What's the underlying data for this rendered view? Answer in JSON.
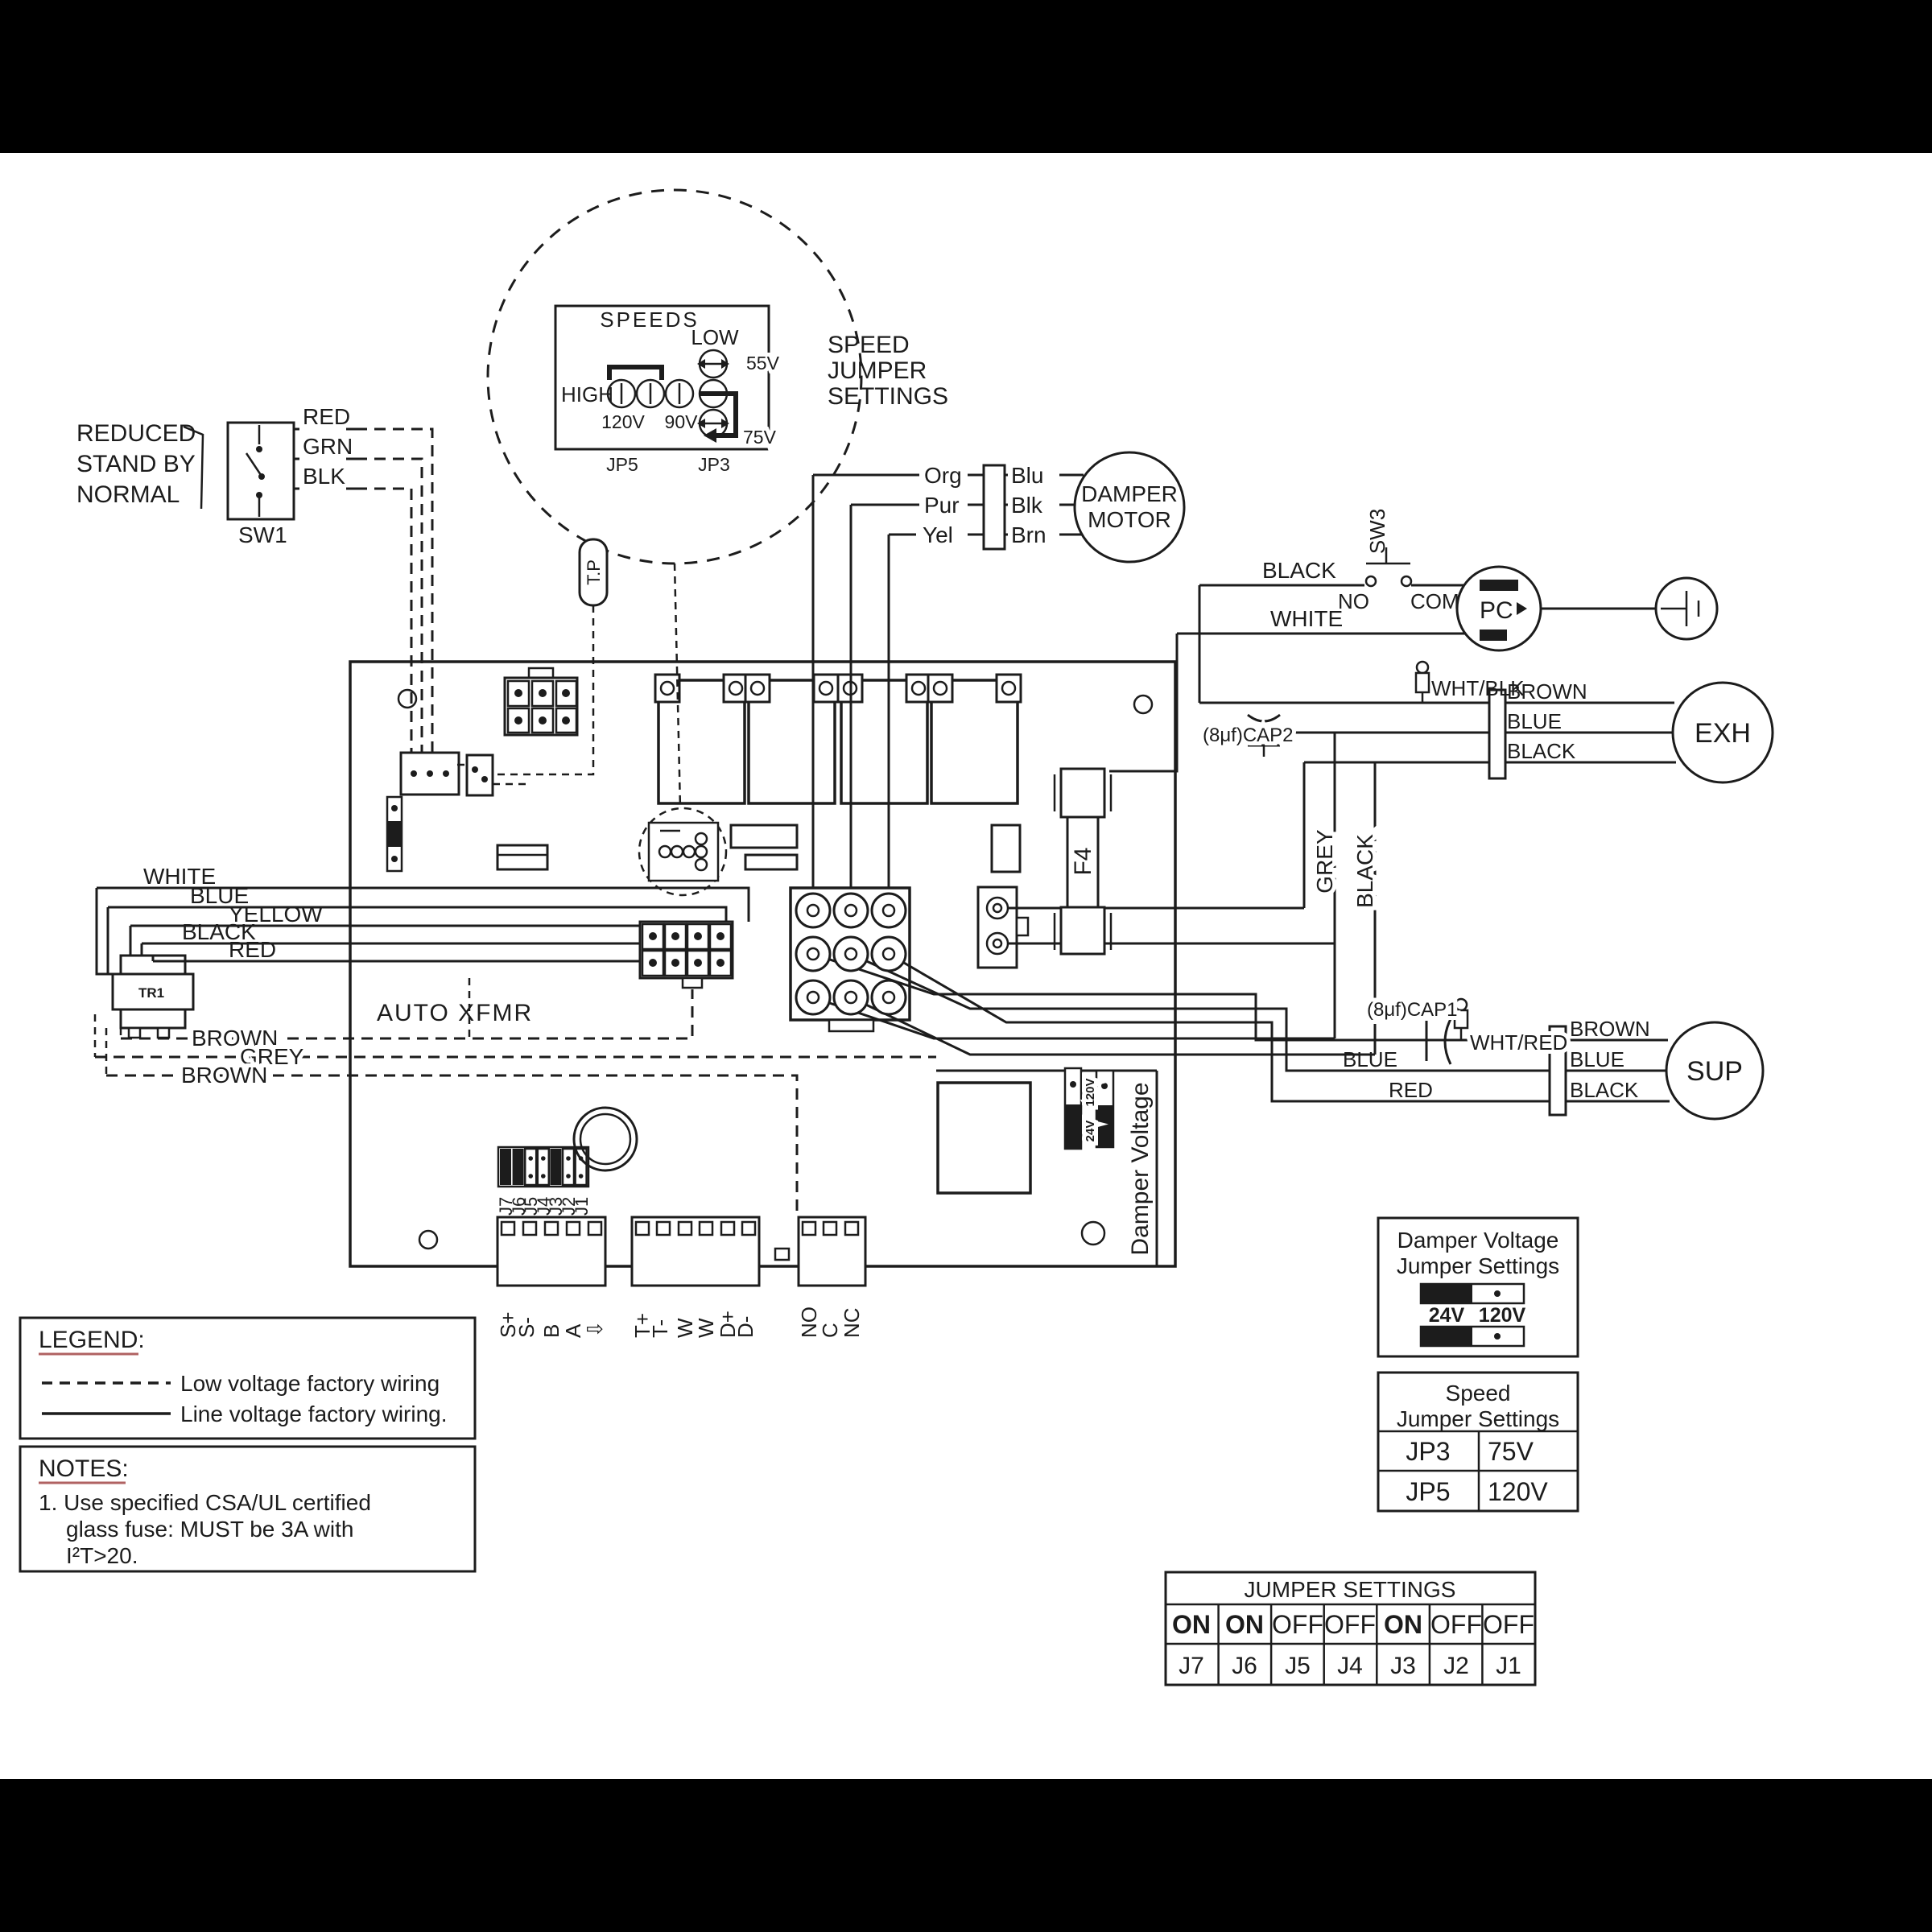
{
  "sw1": {
    "line1": "REDUCED",
    "line2": "STAND BY",
    "line3": "NORMAL",
    "name": "SW1",
    "wires": [
      "RED",
      "GRN",
      "BLK"
    ]
  },
  "speed_detail": {
    "title": "SPEEDS",
    "low": "LOW",
    "high": "HIGH",
    "v120": "120V",
    "v90": "90V",
    "v55": "55V",
    "v75": "75V",
    "jp5": "JP5",
    "jp3": "JP3",
    "callout": [
      "SPEED",
      "JUMPER",
      "SETTINGS"
    ]
  },
  "damper_motor": {
    "left": [
      "Org",
      "Pur",
      "Yel"
    ],
    "right": [
      "Blu",
      "Blk",
      "Brn"
    ],
    "name1": "DAMPER",
    "name2": "MOTOR"
  },
  "tp": {
    "label": "T.P"
  },
  "sw3": {
    "name": "SW3",
    "black": "BLACK",
    "white": "WHITE",
    "no": "NO",
    "com": "COM"
  },
  "pc": {
    "label": "PC"
  },
  "exh": {
    "cap": "(8μf)CAP2",
    "whtblk": "WHT/BLK",
    "brown": "BROWN",
    "blue": "BLUE",
    "black": "BLACK",
    "name": "EXH"
  },
  "vertical_wires": {
    "grey": "GREY",
    "black": "BLACK"
  },
  "f4": {
    "label": "F4"
  },
  "sup": {
    "cap": "(8μf)CAP1",
    "whtred": "WHT/RED",
    "brown": "BROWN",
    "blue": "BLUE",
    "black": "BLACK",
    "name": "SUP",
    "left_blue": "BLUE",
    "left_red": "RED"
  },
  "tr1": {
    "name": "TR1",
    "wires": [
      "WHITE",
      "BLUE",
      "YELLOW",
      "BLACK",
      "RED"
    ],
    "dashed": [
      "BROWN",
      "GREY",
      "BROWN"
    ],
    "auto_xfmr": "AUTO XFMR"
  },
  "board": {
    "damper_voltage": "Damper Voltage",
    "jv24": "24V",
    "jv120": "120V"
  },
  "terminals": {
    "s_block": [
      "S+",
      "S-",
      "B",
      "A",
      "⇩"
    ],
    "t_block": [
      "T+",
      "T-",
      "W",
      "W",
      "D+",
      "D-"
    ],
    "relay_block": [
      "NO",
      "C",
      "NC"
    ],
    "jumpers": [
      "J7",
      "J6",
      "J5",
      "J4",
      "J3",
      "J2",
      "J1"
    ]
  },
  "legend": {
    "title": "LEGEND:",
    "low": "Low voltage factory wiring",
    "line": "Line voltage factory wiring."
  },
  "notes": {
    "title": "NOTES:",
    "l1": "1. Use specified CSA/UL certified",
    "l2": "glass fuse: MUST  be 3A with",
    "l3": "I²T>20."
  },
  "dv_box": {
    "t1": "Damper Voltage",
    "t2": "Jumper Settings",
    "v24": "24V",
    "v120": "120V"
  },
  "speed_box": {
    "t1": "Speed",
    "t2": "Jumper Settings",
    "rows": [
      {
        "jp": "JP3",
        "v": "75V"
      },
      {
        "jp": "JP5",
        "v": "120V"
      }
    ]
  },
  "jumper_table": {
    "title": "JUMPER SETTINGS",
    "states": [
      "ON",
      "ON",
      "OFF",
      "OFF",
      "ON",
      "OFF",
      "OFF"
    ],
    "names": [
      "J7",
      "J6",
      "J5",
      "J4",
      "J3",
      "J2",
      "J1"
    ]
  },
  "colors": {
    "ink": "#1c1c1c",
    "paper": "#ffffff",
    "underline": "#b06262"
  }
}
